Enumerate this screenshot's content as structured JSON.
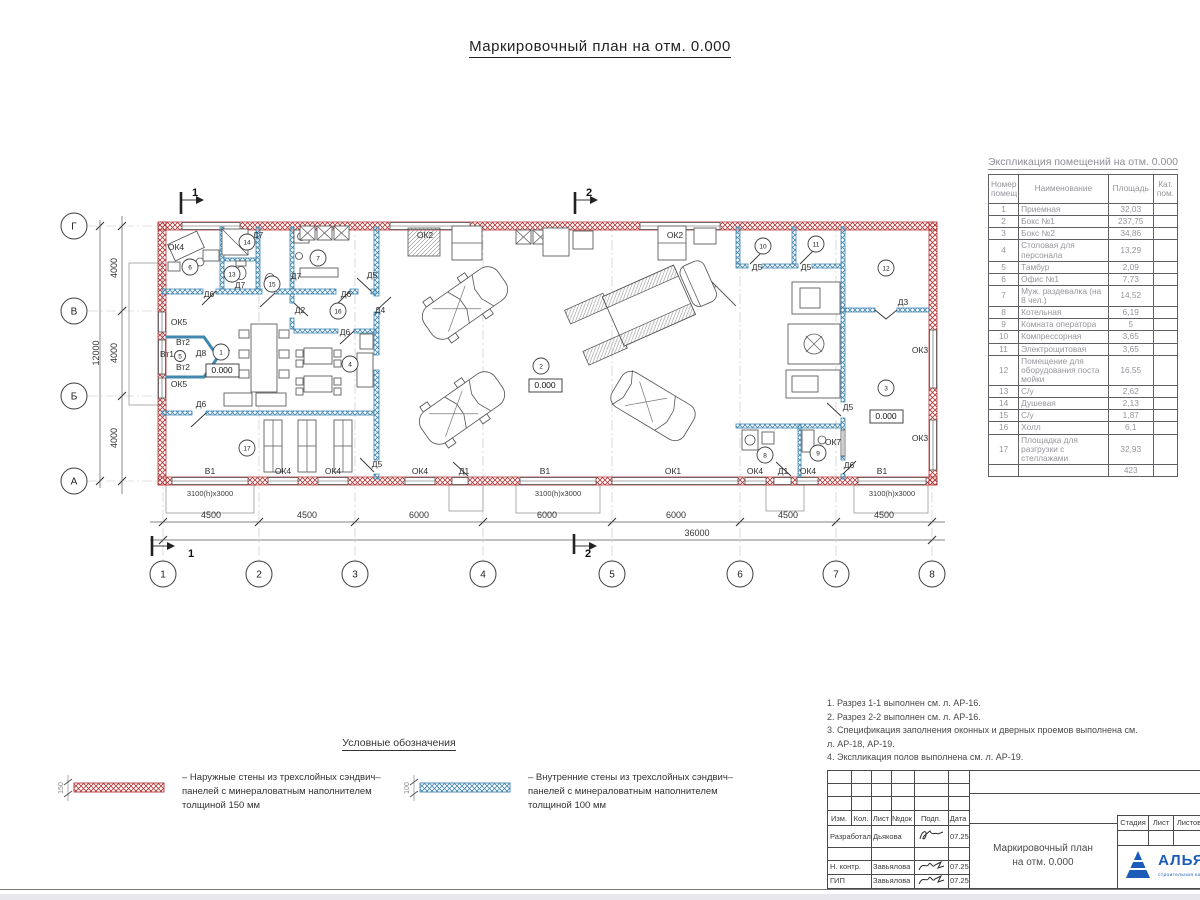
{
  "title": "Маркировочный план на отм. 0.000",
  "schedule": {
    "title": "Экспликация помещений на отм. 0.000",
    "headers": {
      "num": "Номер\nпомещ.",
      "name": "Наименование",
      "area": "Площадь",
      "cat": "Кат.\nпом."
    },
    "rows": [
      {
        "num": "1",
        "name": "Приемная",
        "area": "32,03"
      },
      {
        "num": "2",
        "name": "Бокс №1",
        "area": "237,75"
      },
      {
        "num": "3",
        "name": "Бокс №2",
        "area": "34,86"
      },
      {
        "num": "4",
        "name": "Столовая для персонала",
        "area": "13,29"
      },
      {
        "num": "5",
        "name": "Тамбур",
        "area": "2,09"
      },
      {
        "num": "6",
        "name": "Офис №1",
        "area": "7,73"
      },
      {
        "num": "7",
        "name": "Муж. раздевалка (на 8 чел.)",
        "area": "14,52"
      },
      {
        "num": "8",
        "name": "Котельная",
        "area": "6,19"
      },
      {
        "num": "9",
        "name": "Комната оператора",
        "area": "5"
      },
      {
        "num": "10",
        "name": "Компрессорная",
        "area": "3,65"
      },
      {
        "num": "11",
        "name": "Электрощитовая",
        "area": "3,65"
      },
      {
        "num": "12",
        "name": "Помещение для оборудования поста мойки",
        "area": "16,55"
      },
      {
        "num": "13",
        "name": "С/у",
        "area": "2,62"
      },
      {
        "num": "14",
        "name": "Душевая",
        "area": "2,13"
      },
      {
        "num": "15",
        "name": "С/у",
        "area": "1,87"
      },
      {
        "num": "16",
        "name": "Холл",
        "area": "6,1"
      },
      {
        "num": "17",
        "name": "Площадка для разгрузки с стеллажами",
        "area": "32,93"
      }
    ],
    "total": "423"
  },
  "notes": [
    "1. Разрез 1-1 выполнен см. л. АР-16.",
    "2. Разрез 2-2 выполнен см. л. АР-16.",
    "3. Спецификация заполнения оконных и дверных проемов выполнена см. л. АР-18, АР-19.",
    "4. Экспликация полов выполнена см. л. АР-19."
  ],
  "legend": {
    "title": "Условные обозначения",
    "items": [
      {
        "dim": "150",
        "type": "outer",
        "text": "– Наружные стены из трехслойных сэндвич–панелей с минераловатным наполнителем толщиной 150 мм"
      },
      {
        "dim": "100",
        "type": "inner",
        "text": "– Внутренние стены из трехслойных сэндвич–панелей с минераловатным наполнителем толщиной 100 мм"
      }
    ]
  },
  "titleblock": {
    "header_cols": [
      "Изм.",
      "Кол.",
      "Лист",
      "№док",
      "Подп.",
      "Дата"
    ],
    "rows": [
      {
        "role": "Разработал",
        "name": "Дьякова",
        "date": "07.25"
      },
      {
        "role": "Н. контр.",
        "name": "Завьялова",
        "date": "07.25"
      },
      {
        "role": "ГИП",
        "name": "Завьялова",
        "date": "07.25"
      }
    ],
    "doc_title1": "Маркировочный план",
    "doc_title2": "на отм. 0.000",
    "stage_cols": [
      "Стадия",
      "Лист",
      "Листов"
    ],
    "company": "АЛЬЯНС",
    "company_sub": "строительная компания"
  },
  "colors": {
    "outer_wall": "#b23535",
    "inner_wall": "#4187b0",
    "logo_blue": "#1b5cb8"
  },
  "plan": {
    "axes_x": [
      {
        "n": "1",
        "x": 163
      },
      {
        "n": "2",
        "x": 259
      },
      {
        "n": "3",
        "x": 355
      },
      {
        "n": "4",
        "x": 483
      },
      {
        "n": "5",
        "x": 612
      },
      {
        "n": "6",
        "x": 740
      },
      {
        "n": "7",
        "x": 836
      },
      {
        "n": "8",
        "x": 932
      }
    ],
    "axes_y": [
      {
        "n": "Г",
        "y": 226
      },
      {
        "n": "В",
        "y": 311
      },
      {
        "n": "Б",
        "y": 396
      },
      {
        "n": "А",
        "y": 481
      }
    ],
    "rooms": [
      {
        "n": "1",
        "x": 221,
        "y": 352
      },
      {
        "n": "2",
        "x": 541,
        "y": 366
      },
      {
        "n": "3",
        "x": 886,
        "y": 388
      },
      {
        "n": "4",
        "x": 350,
        "y": 364
      },
      {
        "n": "5",
        "x": 180,
        "y": 356,
        "r": 5.5
      },
      {
        "n": "6",
        "x": 190,
        "y": 267
      },
      {
        "n": "7",
        "x": 318,
        "y": 258
      },
      {
        "n": "8",
        "x": 765,
        "y": 455
      },
      {
        "n": "9",
        "x": 818,
        "y": 453
      },
      {
        "n": "10",
        "x": 763,
        "y": 246
      },
      {
        "n": "11",
        "x": 816,
        "y": 244
      },
      {
        "n": "12",
        "x": 886,
        "y": 268
      },
      {
        "n": "13",
        "x": 232,
        "y": 274
      },
      {
        "n": "14",
        "x": 247,
        "y": 242
      },
      {
        "n": "15",
        "x": 272,
        "y": 284
      },
      {
        "n": "16",
        "x": 338,
        "y": 311
      },
      {
        "n": "17",
        "x": 247,
        "y": 448
      }
    ],
    "labels": [
      {
        "t": "4500",
        "x": 211,
        "y": 518,
        "c": "dim"
      },
      {
        "t": "4500",
        "x": 307,
        "y": 518,
        "c": "dim"
      },
      {
        "t": "6000",
        "x": 419,
        "y": 518,
        "c": "dim"
      },
      {
        "t": "6000",
        "x": 547,
        "y": 518,
        "c": "dim"
      },
      {
        "t": "6000",
        "x": 676,
        "y": 518,
        "c": "dim"
      },
      {
        "t": "4500",
        "x": 788,
        "y": 518,
        "c": "dim"
      },
      {
        "t": "4500",
        "x": 884,
        "y": 518,
        "c": "dim"
      },
      {
        "t": "36000",
        "x": 697,
        "y": 536,
        "c": "dim"
      },
      {
        "t": "4000",
        "x": 117,
        "y": 268,
        "r": -90,
        "c": "dim"
      },
      {
        "t": "4000",
        "x": 117,
        "y": 353,
        "r": -90,
        "c": "dim"
      },
      {
        "t": "4000",
        "x": 117,
        "y": 438,
        "r": -90,
        "c": "dim"
      },
      {
        "t": "12000",
        "x": 99,
        "y": 353,
        "r": -90,
        "c": "dim"
      },
      {
        "t": "1",
        "x": 195,
        "y": 196,
        "c": "sec"
      },
      {
        "t": "2",
        "x": 589,
        "y": 196,
        "c": "sec"
      },
      {
        "t": "1",
        "x": 191,
        "y": 557,
        "c": "sec"
      },
      {
        "t": "2",
        "x": 588,
        "y": 557,
        "c": "sec"
      },
      {
        "t": "0.000",
        "x": 222,
        "y": 373,
        "c": "elev"
      },
      {
        "t": "0.000",
        "x": 545,
        "y": 388,
        "c": "elev"
      },
      {
        "t": "0.000",
        "x": 886,
        "y": 419,
        "c": "elev"
      },
      {
        "t": "3100(h)x3000",
        "x": 210,
        "y": 496,
        "c": "gate"
      },
      {
        "t": "3100(h)x3000",
        "x": 558,
        "y": 496,
        "c": "gate"
      },
      {
        "t": "3100(h)x3000",
        "x": 892,
        "y": 496,
        "c": "gate"
      },
      {
        "t": "ОК4",
        "x": 176,
        "y": 250
      },
      {
        "t": "ОК2",
        "x": 425,
        "y": 238
      },
      {
        "t": "ОК2",
        "x": 675,
        "y": 238
      },
      {
        "t": "Д5",
        "x": 757,
        "y": 270
      },
      {
        "t": "Д5",
        "x": 806,
        "y": 270
      },
      {
        "t": "Д3",
        "x": 903,
        "y": 305
      },
      {
        "t": "ОК3",
        "x": 920,
        "y": 353
      },
      {
        "t": "ОК3",
        "x": 920,
        "y": 441
      },
      {
        "t": "Д5",
        "x": 848,
        "y": 410
      },
      {
        "t": "ОК7",
        "x": 833,
        "y": 445
      },
      {
        "t": "Д6",
        "x": 849,
        "y": 468
      },
      {
        "t": "Д5",
        "x": 372,
        "y": 278
      },
      {
        "t": "Д4",
        "x": 380,
        "y": 313
      },
      {
        "t": "Д6",
        "x": 346,
        "y": 297
      },
      {
        "t": "Д2",
        "x": 300,
        "y": 313
      },
      {
        "t": "Д7",
        "x": 258,
        "y": 238
      },
      {
        "t": "Д7",
        "x": 240,
        "y": 288
      },
      {
        "t": "Д7",
        "x": 296,
        "y": 279
      },
      {
        "t": "Д6",
        "x": 209,
        "y": 297
      },
      {
        "t": "Д8",
        "x": 201,
        "y": 356
      },
      {
        "t": "Вт2",
        "x": 183,
        "y": 345
      },
      {
        "t": "Вт1",
        "x": 167,
        "y": 357
      },
      {
        "t": "Вт2",
        "x": 183,
        "y": 370
      },
      {
        "t": "ОК5",
        "x": 179,
        "y": 325
      },
      {
        "t": "ОК5",
        "x": 179,
        "y": 387
      },
      {
        "t": "Д6",
        "x": 345,
        "y": 335
      },
      {
        "t": "Д6",
        "x": 201,
        "y": 407
      },
      {
        "t": "Д5",
        "x": 377,
        "y": 467
      },
      {
        "t": "В1",
        "x": 210,
        "y": 474
      },
      {
        "t": "ОК4",
        "x": 283,
        "y": 474
      },
      {
        "t": "ОК4",
        "x": 333,
        "y": 474
      },
      {
        "t": "ОК4",
        "x": 420,
        "y": 474
      },
      {
        "t": "Д1",
        "x": 464,
        "y": 474
      },
      {
        "t": "В1",
        "x": 545,
        "y": 474
      },
      {
        "t": "ОК1",
        "x": 673,
        "y": 474
      },
      {
        "t": "ОК4",
        "x": 755,
        "y": 474
      },
      {
        "t": "Д1",
        "x": 783,
        "y": 474
      },
      {
        "t": "ОК4",
        "x": 808,
        "y": 474
      },
      {
        "t": "В1",
        "x": 882,
        "y": 474
      }
    ]
  }
}
